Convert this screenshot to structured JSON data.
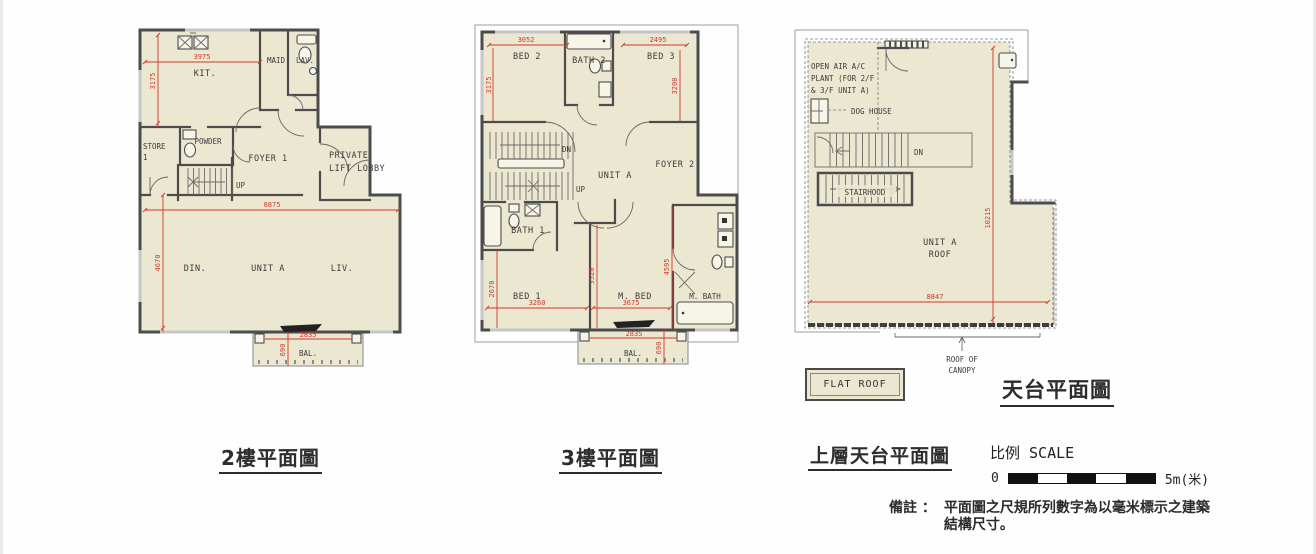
{
  "plans": {
    "floor2": {
      "caption": "2樓平面圖",
      "labels": {
        "kit": "KIT.",
        "maid": "MAID",
        "lav": "LAV.",
        "store_l1": "STORE",
        "store_l2": "1",
        "powder": "POWDER",
        "foyer": "FOYER 1",
        "private_l1": "PRIVATE",
        "private_l2": "LIFT LOBBY",
        "up": "UP",
        "din": "DIN.",
        "unit": "UNIT A",
        "liv": "LIV.",
        "bal": "BAL."
      },
      "dims": {
        "kit_w": "3975",
        "kit_h": "3175",
        "main_w": "8875",
        "main_h": "4670",
        "bal_w": "2835",
        "bal_d": "690"
      }
    },
    "floor3": {
      "caption": "3樓平面圖",
      "labels": {
        "bed2": "BED 2",
        "bath2": "BATH 2",
        "bed3": "BED 3",
        "dn": "DN",
        "up": "UP",
        "unit": "UNIT A",
        "foyer": "FOYER 2",
        "bath1": "BATH 1",
        "bed1": "BED 1",
        "mbed": "M. BED",
        "mbath": "M. BATH",
        "bal": "BAL."
      },
      "dims": {
        "bed2_w": "3052",
        "bed2_h": "3175",
        "bed3_w": "2495",
        "bed3_h": "3200",
        "bed1_h": "2670",
        "bed1_w": "3260",
        "hall_h": "3520",
        "mbed_w": "3675",
        "mbed_h": "4595",
        "bal_w": "2835",
        "bal_d": "690"
      }
    },
    "roof": {
      "caption": "上層天台平面圖",
      "title": "天台平面圖",
      "labels": {
        "ac_l1": "OPEN AIR A/C",
        "ac_l2": "PLANT (FOR 2/F",
        "ac_l3": "& 3/F UNIT A)",
        "dog_house": "DOG HOUSE",
        "dn": "DN",
        "stairhood": "STAIRHOOD",
        "unit_l1": "UNIT A",
        "unit_l2": "ROOF",
        "canopy_l1": "ROOF OF",
        "canopy_l2": "CANOPY"
      },
      "dims": {
        "h": "10215",
        "w": "8847"
      }
    }
  },
  "legend": {
    "flat_roof": "FLAT ROOF"
  },
  "scale": {
    "label": "比例 SCALE",
    "zero": "0",
    "five": "5m(米)"
  },
  "note": {
    "label": "備註 ：",
    "line1": "平面圖之尺規所列數字為以毫米標示之建築",
    "line2": "結構尺寸。"
  },
  "colors": {
    "floor_fill": "#ece7d1",
    "wall": "#4c4c4c",
    "dim_red": "#cf382c"
  }
}
